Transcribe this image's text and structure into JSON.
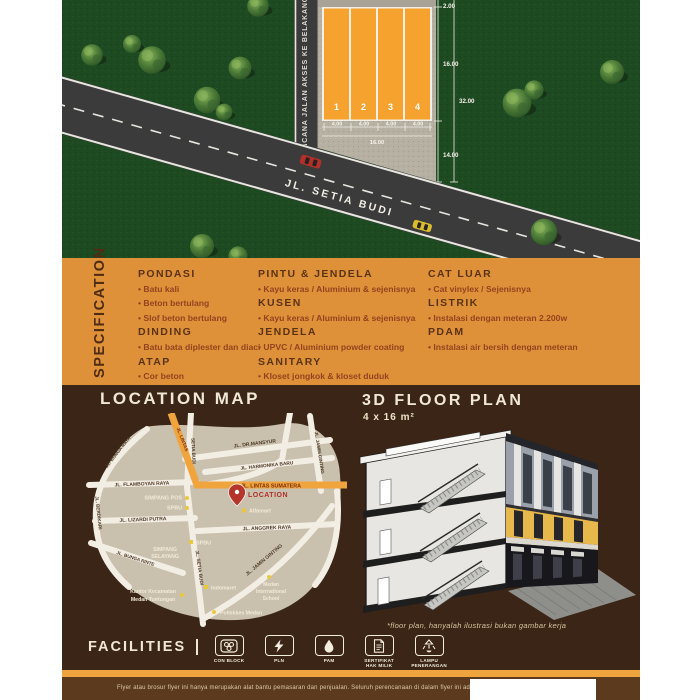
{
  "palette": {
    "lot_orange": "#F6A22E",
    "spec_band_orange": "#DF9139",
    "dark_brown": "#3A2516",
    "footer_brown": "#5C3A1E",
    "grass_green": "#1E4A22",
    "map_land_tan": "#C9C0AE",
    "highway_orange": "#EFA43E",
    "location_red": "#B5352B"
  },
  "site_plan": {
    "access_road_label": "RENCANA JALAN AKSES KE BELAKANG",
    "street_label": "JL. SETIA BUDI",
    "lots": [
      "1",
      "2",
      "3",
      "4"
    ],
    "lot_widths": [
      "4.00",
      "4.00",
      "4.00",
      "4.00"
    ],
    "width_total": "16.00",
    "dim_back": "2.00",
    "dim_lot_depth": "16.00",
    "dim_front": "14.00",
    "dim_total_depth": "32.00"
  },
  "specification": {
    "title": "SPECIFICATION",
    "columns": [
      {
        "groups": [
          {
            "heading": "PONDASI",
            "items": [
              "Batu kali",
              "Beton bertulang",
              "Slof beton bertulang"
            ]
          },
          {
            "heading": "DINDING",
            "items": [
              "Batu bata diplester dan diaci"
            ]
          },
          {
            "heading": "ATAP",
            "items": [
              "Cor beton"
            ]
          }
        ]
      },
      {
        "groups": [
          {
            "heading": "PINTU & JENDELA",
            "items": [
              "Kayu keras / Aluminium & sejenisnya"
            ]
          },
          {
            "heading": "KUSEN",
            "items": [
              "Kayu keras / Aluminium & sejenisnya"
            ]
          },
          {
            "heading": "JENDELA",
            "items": [
              "UPVC / Aluminium powder coating"
            ]
          },
          {
            "heading": "SANITARY",
            "items": [
              "Kloset jongkok & kloset duduk"
            ]
          }
        ]
      },
      {
        "groups": [
          {
            "heading": "CAT LUAR",
            "items": [
              "Cat vinylex / Sejenisnya"
            ]
          },
          {
            "heading": "LISTRIK",
            "items": [
              "Instalasi dengan meteran 2.200w"
            ]
          },
          {
            "heading": "PDAM",
            "items": [
              "Instalasi air bersih dengan meteran"
            ]
          }
        ]
      }
    ]
  },
  "location_map": {
    "title": "LOCATION MAP",
    "roads": {
      "dr_mansyur": "JL. DR.MANSYUR",
      "jamin_ginting_top": "JL. JAMIN GINTING",
      "harmonika": "JL. HARMONIKA BARU",
      "lintas": "JL. LINTAS",
      "lintas_sumatera": "JL. LINTAS SUMATERA",
      "flamboyan": "JL. FLAMBOYAN RAYA",
      "bunga_raya": "JL. BUNGA RAYA",
      "berdikari": "JL. BERDIKARI",
      "bunga_rinte": "JL. BUNGA RINTE",
      "lizardi": "JL. LIZARDI PUTRA",
      "anggrek": "JL. ANGGREK RAYA",
      "setia_budi_upper": "SETIA BUDI",
      "setia_budi": "JL. SETIA BUDI",
      "jamin_ginting": "JL. JAMIN GINTING"
    },
    "pois": {
      "simpang_pos": "SIMPANG POS",
      "spbu1": "SPBU",
      "location": "LOCATION",
      "alfamart": "Alfamart",
      "spbu2": "SPBU",
      "simpang_selayang_1": "SIMPANG",
      "simpang_selayang_2": "SELAYANG",
      "kantor_1": "Kantor Kecamatan",
      "kantor_2": "Medan Tuntungan",
      "indomaret": "Indomaret",
      "mis_1": "Medan",
      "mis_2": "International",
      "mis_3": "School",
      "poltekkes": "Poltekkes Medan"
    }
  },
  "floor_plan": {
    "title": "3D FLOOR PLAN",
    "subtitle": "4 x 16 m²",
    "disclaimer": "*floor plan, hanyalah ilustrasi bukan gambar kerja"
  },
  "facilities": {
    "title": "FACILITIES",
    "items": [
      {
        "line1": "CON BLOCK",
        "line2": ""
      },
      {
        "line1": "PLN",
        "line2": ""
      },
      {
        "line1": "PAM",
        "line2": ""
      },
      {
        "line1": "SERTIFIKAT",
        "line2": "HAK MILIK"
      },
      {
        "line1": "LAMPU",
        "line2": "PENERANGAN"
      }
    ]
  },
  "footer": {
    "text": "Flyer atau brosur flyer ini hanya merupakan alat bantu pemasaran dan penjualan. Seluruh perencanaan di dalam flyer ini adalah hanya ilustrasi bukan gambar kerja."
  }
}
